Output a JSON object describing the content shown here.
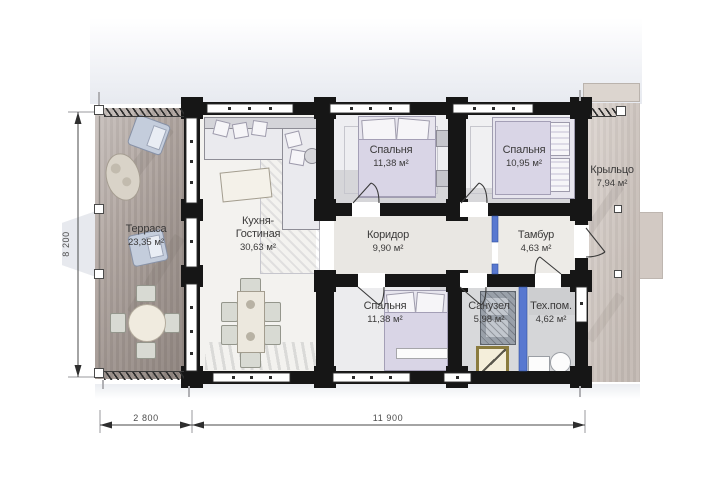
{
  "plan": {
    "rooms": {
      "terrace": {
        "name": "Терраса",
        "area": "23,35 м²"
      },
      "kitchen_living": {
        "name_line1": "Кухня-",
        "name_line2": "Гостиная",
        "area": "30,63 м²"
      },
      "bedroom_top_left": {
        "name": "Спальня",
        "area": "11,38 м²"
      },
      "bedroom_top_right": {
        "name": "Спальня",
        "area": "10,95 м²"
      },
      "corridor": {
        "name": "Коридор",
        "area": "9,90 м²"
      },
      "vestibule": {
        "name": "Тамбур",
        "area": "4,63 м²"
      },
      "bedroom_bottom": {
        "name": "Спальня",
        "area": "11,38 м²"
      },
      "bathroom": {
        "name": "Санузел",
        "area": "5,98 м²"
      },
      "tech_room": {
        "name": "Тех.пом.",
        "area": "4,62 м²"
      },
      "porch": {
        "name": "Крыльцо",
        "area": "7,94 м²"
      }
    },
    "dimensions": {
      "total_depth": "8 200",
      "terrace_width": "2 800",
      "house_width": "11 900"
    },
    "colors": {
      "walls": "#161616",
      "partition_blue": "#5878d0",
      "terrace_floor": "#b0a6a1",
      "porch_floor": "#d2c9c2",
      "shower_accent": "#8a7b3e"
    }
  }
}
